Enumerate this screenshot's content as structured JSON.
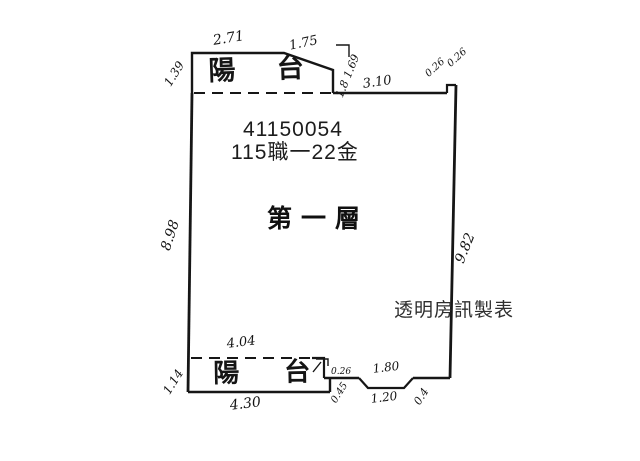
{
  "plan": {
    "id_number": "41150054",
    "lot_label": "115職一22金",
    "floor_label": "第一層",
    "watermark": "透明房訊製表",
    "balcony_top": "陽 台",
    "balcony_bottom": "陽 台",
    "dims": {
      "top_left": "1.39",
      "top_edge": "2.71",
      "top_slope": "1.75",
      "slope_side": "1.8 1.69",
      "top_wall": "3.10",
      "step_a": "0.26",
      "step_b": "0.26",
      "left_wall": "8.98",
      "right_wall": "9.82",
      "balcony_top_width": "4.04",
      "balcony_bottom_width": "4.30",
      "balcony_height": "1.14",
      "notch_offset": "0.26",
      "notch_height": "0.45",
      "entry_top": "1.80",
      "entry_bottom": "1.20",
      "entry_side": "0.4"
    }
  }
}
